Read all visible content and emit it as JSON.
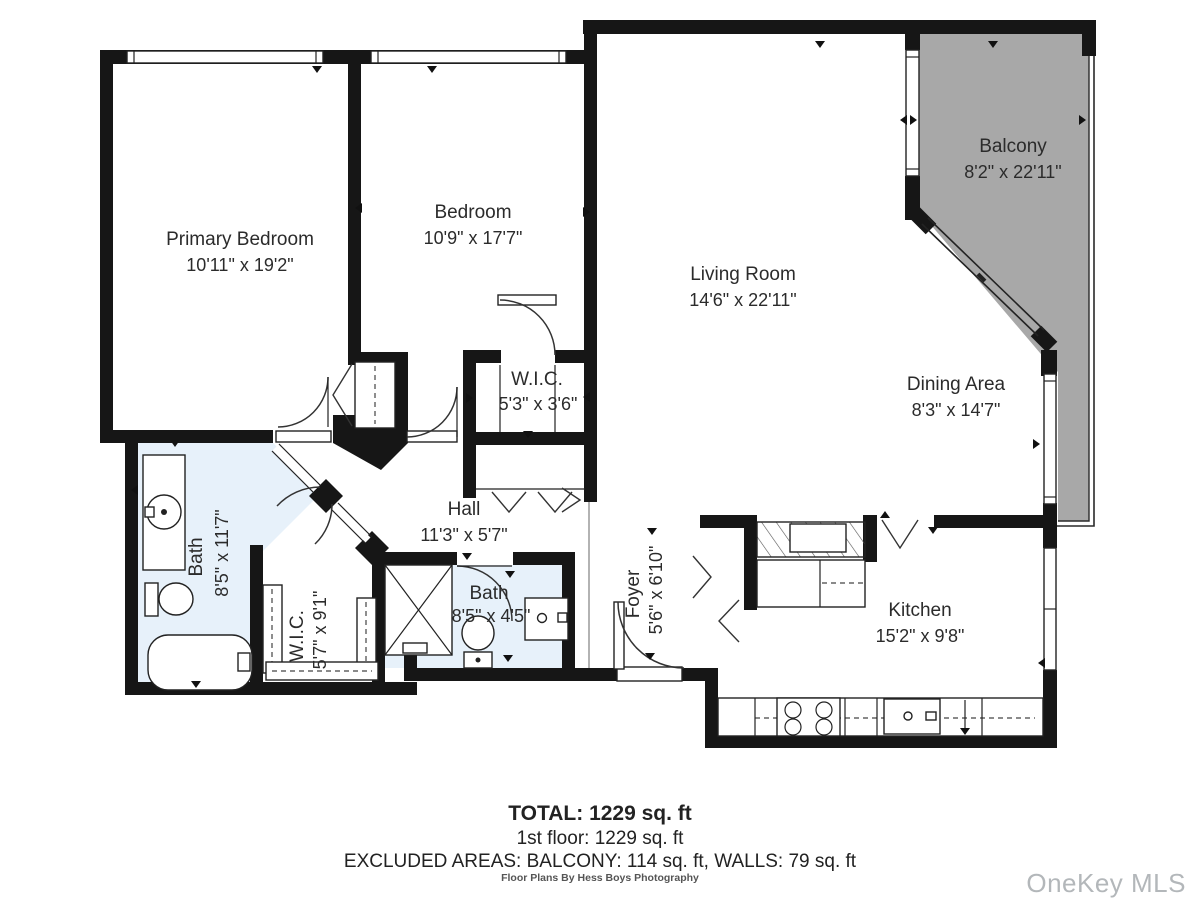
{
  "rooms": {
    "primary_bedroom": {
      "name": "Primary Bedroom",
      "dims": "10'11\" x 19'2\""
    },
    "bedroom": {
      "name": "Bedroom",
      "dims": "10'9\" x 17'7\""
    },
    "living_room": {
      "name": "Living Room",
      "dims": "14'6\" x 22'11\""
    },
    "balcony": {
      "name": "Balcony",
      "dims": "8'2\" x 22'11\""
    },
    "dining_area": {
      "name": "Dining Area",
      "dims": "8'3\" x 14'7\""
    },
    "wic_bedroom": {
      "name": "W.I.C.",
      "dims": "5'3\" x 3'6\""
    },
    "hall": {
      "name": "Hall",
      "dims": "11'3\" x 5'7\""
    },
    "bath_primary": {
      "name": "Bath",
      "dims": "8'5\" x 11'7\""
    },
    "wic_primary": {
      "name": "W.I.C.",
      "dims": "5'7\" x 9'1\""
    },
    "bath_hall": {
      "name": "Bath",
      "dims": "8'5\" x 4'5\""
    },
    "foyer": {
      "name": "Foyer",
      "dims": "5'6\" x 6'10\""
    },
    "kitchen": {
      "name": "Kitchen",
      "dims": "15'2\" x 9'8\""
    }
  },
  "summary": {
    "total": "TOTAL: 1229 sq. ft",
    "first_floor": "1st floor: 1229 sq. ft",
    "excluded": "EXCLUDED AREAS: BALCONY: 114 sq. ft, WALLS: 79 sq. ft"
  },
  "credit": "Floor Plans By Hess Boys Photography",
  "watermark": "OneKey MLS",
  "colors": {
    "wall": "#161616",
    "bath_fill": "#e7f1fa",
    "balcony_fill": "#a8a8a8",
    "text": "#2b2b2b",
    "watermark_gray": "#b3b7ba"
  }
}
